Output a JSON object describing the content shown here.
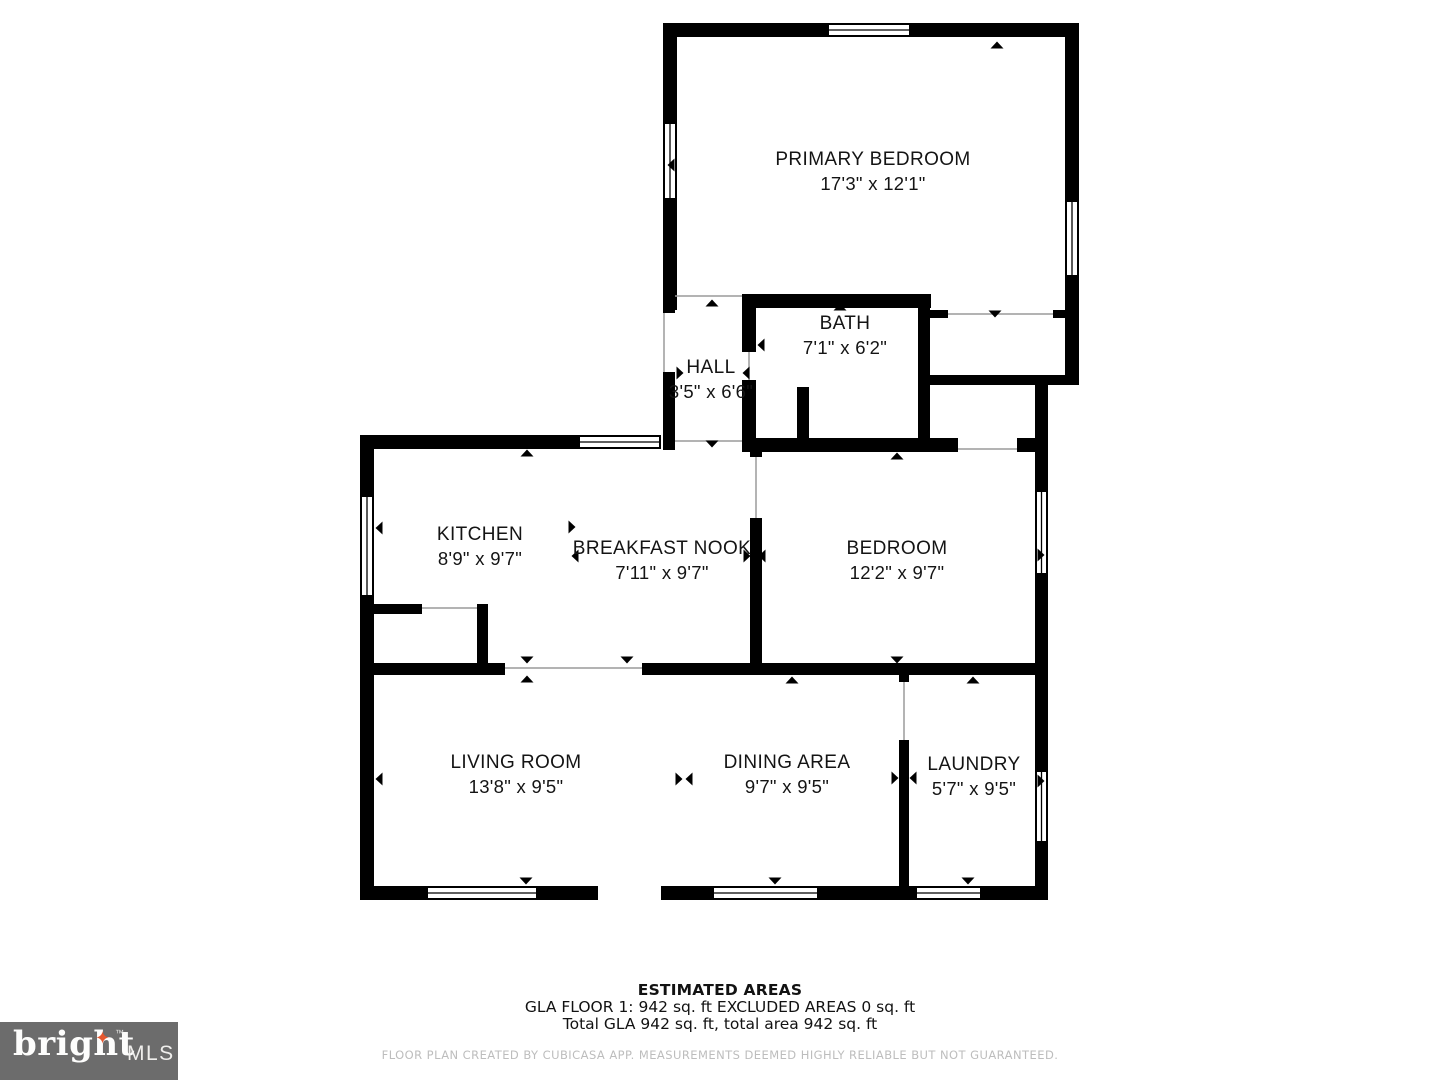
{
  "floor_plan": {
    "rooms": [
      {
        "name": "PRIMARY BEDROOM",
        "dims": "17'3\" x 12'1\""
      },
      {
        "name": "BATH",
        "dims": "7'1\" x 6'2\""
      },
      {
        "name": "HALL",
        "dims": "3'5\" x 6'6\""
      },
      {
        "name": "KITCHEN",
        "dims": "8'9\" x 9'7\""
      },
      {
        "name": "BREAKFAST NOOK",
        "dims": "7'11\" x 9'7\""
      },
      {
        "name": "BEDROOM",
        "dims": "12'2\" x 9'7\""
      },
      {
        "name": "LIVING ROOM",
        "dims": "13'8\" x 9'5\""
      },
      {
        "name": "DINING AREA",
        "dims": "9'7\" x 9'5\""
      },
      {
        "name": "LAUNDRY",
        "dims": "5'7\" x 9'5\""
      }
    ],
    "colors": {
      "wall": "#000000",
      "door_line": "#9a9a9a",
      "background": "#ffffff"
    }
  },
  "footer": {
    "estimated_areas_title": "ESTIMATED AREAS",
    "gla_line": "GLA FLOOR 1: 942 sq. ft EXCLUDED AREAS 0 sq. ft",
    "total_line": "Total GLA 942 sq. ft, total area 942 sq. ft",
    "disclaimer": "FLOOR PLAN CREATED BY CUBICASA APP. MEASUREMENTS DEEMED HIGHLY RELIABLE BUT NOT GUARANTEED."
  },
  "logo": {
    "brand": "bright",
    "star_icon": "✦",
    "trademark": "™",
    "suffix": "MLS",
    "bg_color": "#6c6c6c",
    "star_color": "#e4572e"
  }
}
